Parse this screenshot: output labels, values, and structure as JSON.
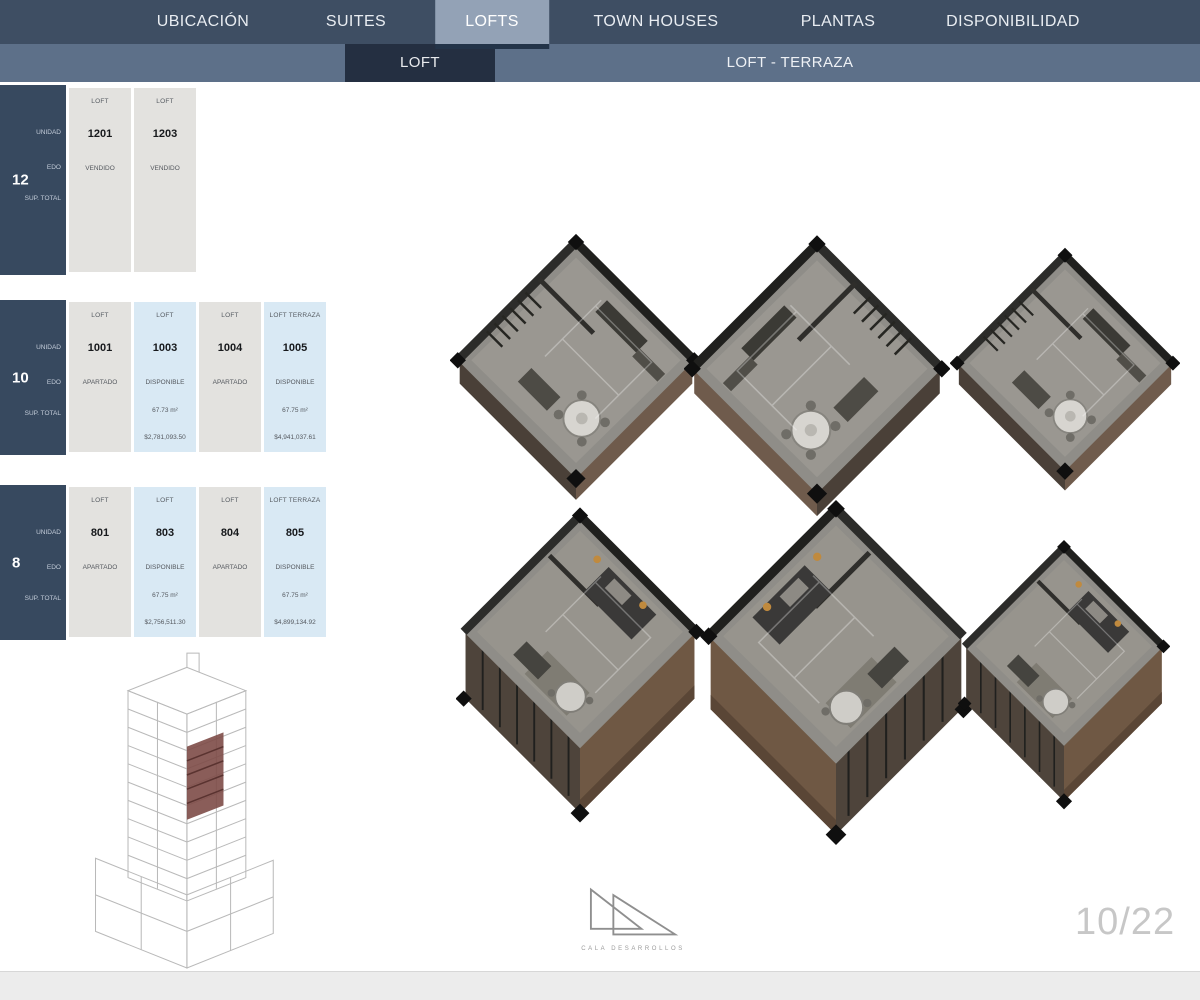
{
  "nav": {
    "items": [
      {
        "label": "UBICACIÓN",
        "active": false
      },
      {
        "label": "SUITES",
        "active": false
      },
      {
        "label": "LOFTS",
        "active": true
      },
      {
        "label": "TOWN HOUSES",
        "active": false
      },
      {
        "label": "PLANTAS",
        "active": false
      },
      {
        "label": "DISPONIBILIDAD",
        "active": false
      }
    ]
  },
  "subnav": {
    "loft_label": "LOFT",
    "terraza_label": "LOFT - TERRAZA"
  },
  "tables": [
    {
      "floor": "12",
      "row_labels": {
        "unit": "UNIDAD",
        "status": "EDO",
        "area": "SUP. TOTAL"
      },
      "columns": [
        {
          "type": "LOFT",
          "unit": "1201",
          "status": "VENDIDO",
          "area": "",
          "price": ""
        },
        {
          "type": "LOFT",
          "unit": "1203",
          "status": "VENDIDO",
          "area": "",
          "price": ""
        }
      ]
    },
    {
      "floor": "10",
      "row_labels": {
        "unit": "UNIDAD",
        "status": "EDO",
        "area": "SUP. TOTAL"
      },
      "columns": [
        {
          "type": "LOFT",
          "unit": "1001",
          "status": "APARTADO",
          "area": "",
          "price": ""
        },
        {
          "type": "LOFT",
          "unit": "1003",
          "status": "DISPONIBLE",
          "area": "67.73 m²",
          "price": "$2,781,093.50"
        },
        {
          "type": "LOFT",
          "unit": "1004",
          "status": "APARTADO",
          "area": "",
          "price": ""
        },
        {
          "type": "LOFT TERRAZA",
          "unit": "1005",
          "status": "DISPONIBLE",
          "area": "67.75 m²",
          "price": "$4,941,037.61"
        }
      ]
    },
    {
      "floor": "8",
      "row_labels": {
        "unit": "UNIDAD",
        "status": "EDO",
        "area": "SUP. TOTAL"
      },
      "columns": [
        {
          "type": "LOFT",
          "unit": "801",
          "status": "APARTADO",
          "area": "",
          "price": ""
        },
        {
          "type": "LOFT",
          "unit": "803",
          "status": "DISPONIBLE",
          "area": "67.75 m²",
          "price": "$2,756,511.30"
        },
        {
          "type": "LOFT",
          "unit": "804",
          "status": "APARTADO",
          "area": "",
          "price": ""
        },
        {
          "type": "LOFT TERRAZA",
          "unit": "805",
          "status": "DISPONIBLE",
          "area": "67.75 m²",
          "price": "$4,899,134.92"
        }
      ]
    }
  ],
  "footer": {
    "page": "10/22",
    "logo_text": "CALA DESARROLLOS"
  },
  "colors": {
    "nav_bg": "#3e4e63",
    "nav_active_bg": "#93a2b6",
    "subnav_bg": "#5d7089",
    "subnav_active_bg": "#242f41",
    "floor_panel_bg": "#37495f",
    "column_gray": "#e3e2df",
    "column_blue": "#d9e9f4",
    "building_highlight": "#7d4b47",
    "page_number_gray": "#c7c7c7"
  }
}
